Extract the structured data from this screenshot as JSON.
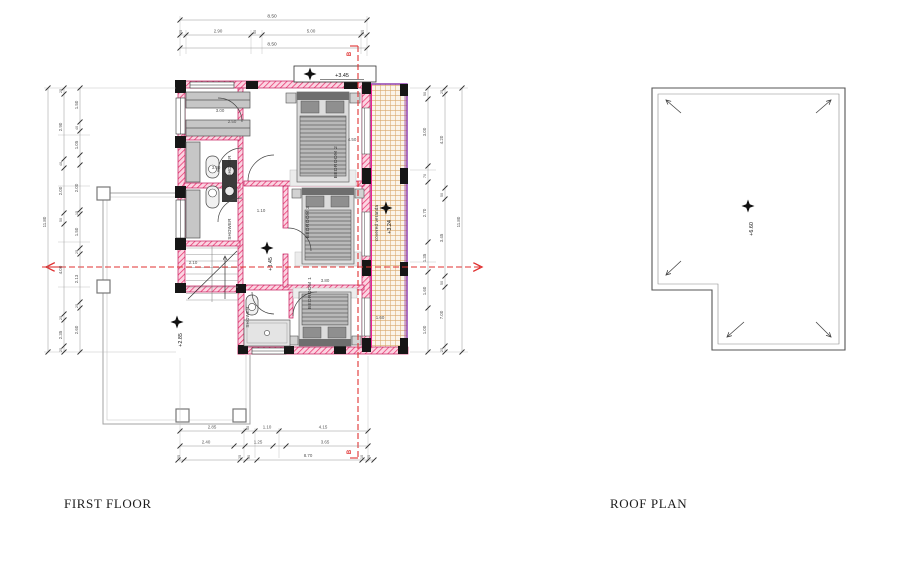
{
  "titles": {
    "first_floor": "FIRST FLOOR",
    "roof_plan": "ROOF PLAN"
  },
  "ff": {
    "rooms": {
      "bedroom2": "BEDROOM 2",
      "bedroom3": "BEDROOM 3",
      "bedroom1": "BEDROOM 1",
      "shower_top": "SHOWER",
      "shower_mid": "SHOWER",
      "shower_bottom": "SHOWER",
      "veranda": "covered veranda"
    },
    "levels": {
      "top": "+3.45",
      "hall": "+3.45",
      "terrace": "+2.85",
      "veranda": "+3.24"
    },
    "section": {
      "b_top": "B",
      "b_bottom": "B"
    },
    "dims": {
      "top_total": "8.50",
      "top_total2": "8.50",
      "top_row": [
        "25",
        "2.90",
        "50",
        "5.00",
        "25"
      ],
      "left_total": "11.80",
      "left_row1": [
        "25",
        "2.90",
        "40",
        "2.00",
        "50",
        "4.00",
        "25",
        "2.35",
        "25"
      ],
      "left_row2": [
        "1.50",
        "40",
        "1.05",
        "2.00",
        "15",
        "1.50",
        "25",
        "2.13",
        "25",
        "2.60"
      ],
      "right_total": "11.80",
      "right_row1": [
        "50",
        "3.00",
        "70",
        "2.70",
        "1.35",
        "1.60",
        "1.00"
      ],
      "right_row2": [
        "25",
        "4.20",
        "50",
        "3.45",
        "50",
        "7.00",
        "25"
      ],
      "bottom_row1": [
        "2.85",
        "50",
        "1.10",
        "4.15"
      ],
      "bottom_row2": [
        "2.40",
        "1.25",
        "3.65"
      ],
      "bottom_row3": [
        "25",
        "25",
        "50",
        "8.70",
        "10",
        "25"
      ],
      "closet_a": "3.00",
      "closet_b": "2.50",
      "shower_w": "3.00",
      "hall_w": "1.10",
      "stair_w": "2.10",
      "bed2_h": "4.50",
      "bed1_w": "3.80",
      "veranda_w": "1.60"
    }
  },
  "roof": {
    "level": "+6.60"
  },
  "colors": {
    "wall_accent": "#e8336d",
    "wall_stroke": "#c2185b",
    "veranda_border": "#8833aa",
    "veranda_hatch": "#d9a86c",
    "section_line": "#e03131",
    "column": "#161616"
  }
}
